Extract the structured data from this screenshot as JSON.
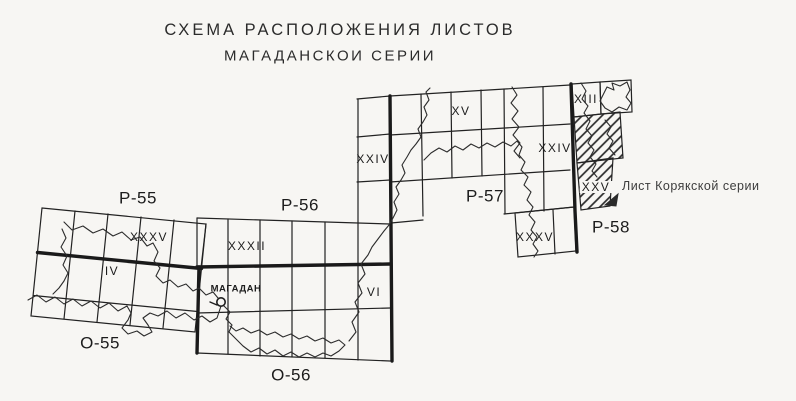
{
  "colors": {
    "paper": "#f7f6f3",
    "ink": "#222222",
    "thick_line": "#1a1a1a",
    "note_ink": "#3d3d3d"
  },
  "title": {
    "line1": "СХЕМА РАСПОЛОЖЕНИЯ ЛИСТОВ",
    "line2": "МАГАДАНСКОИ СЕРИИ"
  },
  "series_labels": {
    "p55": "Р-55",
    "o55": "О-55",
    "p56": "Р-56",
    "o56": "О-56",
    "p57": "Р-57",
    "p58": "Р-58"
  },
  "sheet_labels": {
    "p55_sheet": "XXXV",
    "o55_sheet": "IV",
    "p56_sheet_bottom": "XXXII",
    "p56_sheet_upper": "XXIV",
    "o56_sheet": "VI",
    "p57_sheet_top": "XV",
    "p57_sheet_right": "XXIV",
    "p57_sheet_south": "XXXV",
    "p58_sheet_top": "XIII",
    "p58_sheet_hatched": "XXV"
  },
  "city": {
    "name": "МАГАДАН"
  },
  "annotation": {
    "koryak_series_note": "Лист Корякской серии"
  }
}
